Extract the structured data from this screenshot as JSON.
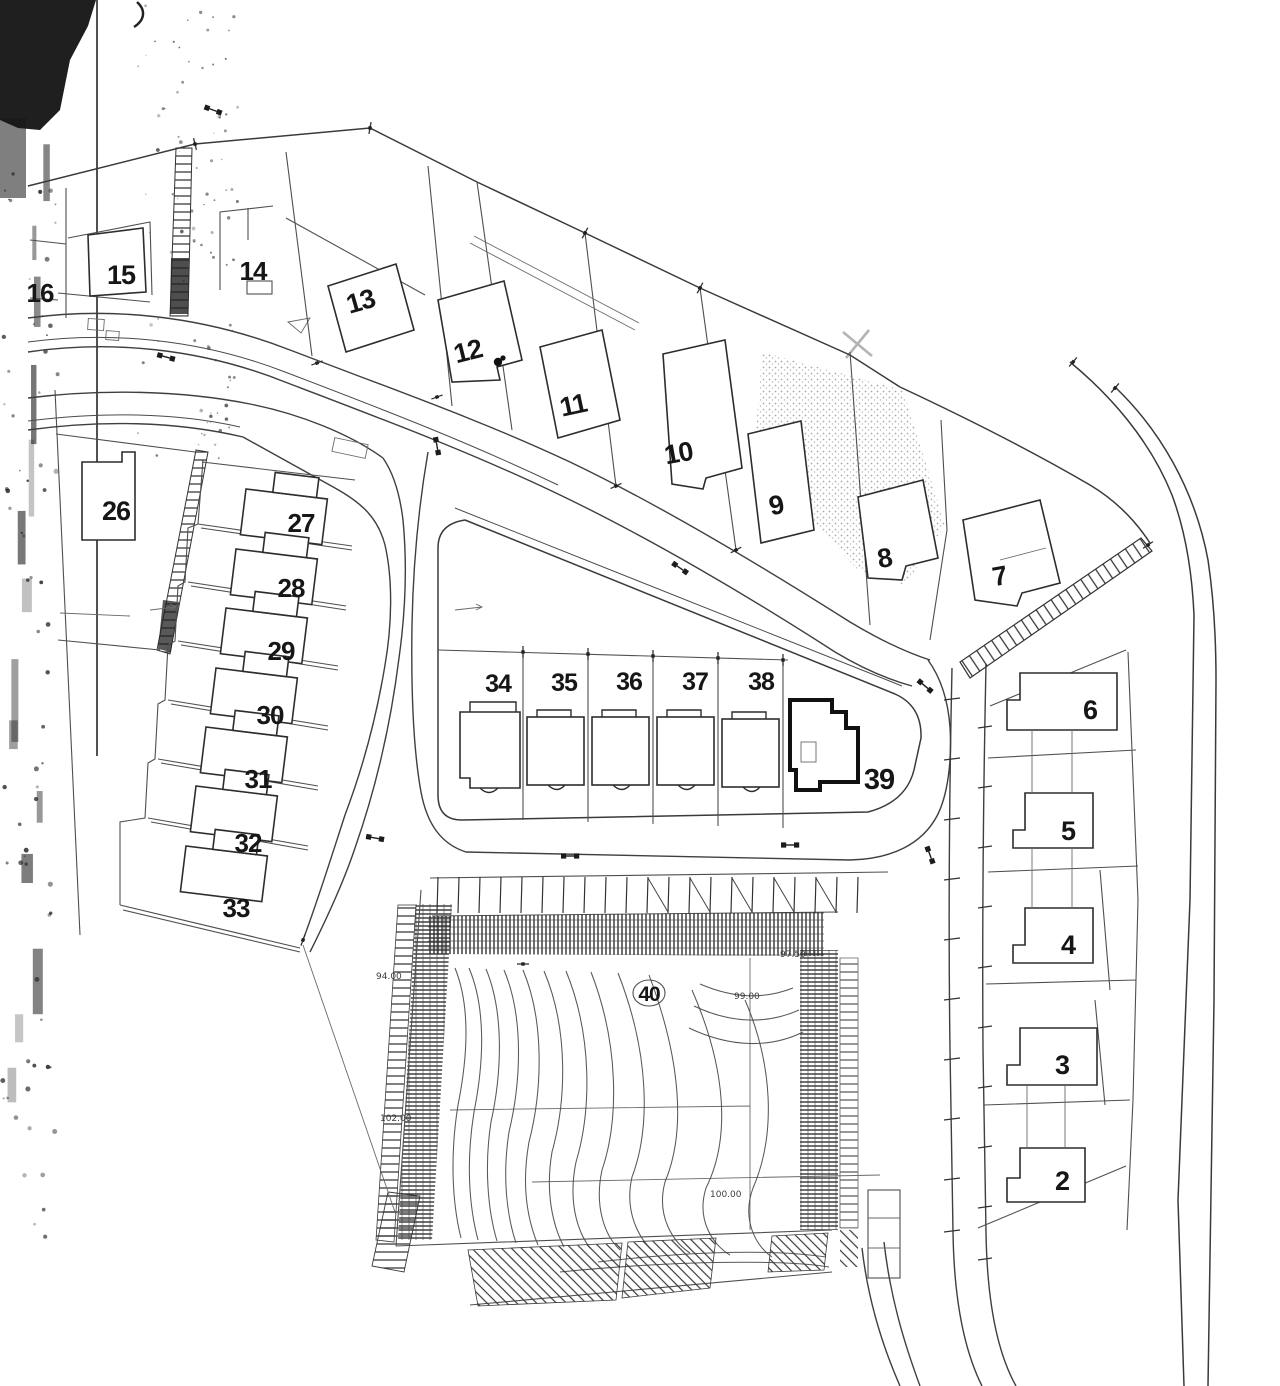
{
  "plan": {
    "kind": "scanned cadastral site plan",
    "colors": {
      "ink": "#2d2d2d",
      "paper": "#ffffff",
      "shade_stipple": "#9a9a9a"
    },
    "circled_lot": "40",
    "lots": [
      {
        "n": "2",
        "x": 1062,
        "y": 1190,
        "s": 27,
        "rot": 0
      },
      {
        "n": "3",
        "x": 1062,
        "y": 1074,
        "s": 27,
        "rot": 0
      },
      {
        "n": "4",
        "x": 1068,
        "y": 954,
        "s": 27,
        "rot": 0
      },
      {
        "n": "5",
        "x": 1068,
        "y": 840,
        "s": 27,
        "rot": 0
      },
      {
        "n": "6",
        "x": 1090,
        "y": 719,
        "s": 27,
        "rot": 0
      },
      {
        "n": "7",
        "x": 1001,
        "y": 585,
        "s": 27,
        "rot": -10
      },
      {
        "n": "8",
        "x": 886,
        "y": 567,
        "s": 27,
        "rot": -10
      },
      {
        "n": "9",
        "x": 778,
        "y": 514,
        "s": 27,
        "rot": -12
      },
      {
        "n": "10",
        "x": 680,
        "y": 462,
        "s": 27,
        "rot": -10
      },
      {
        "n": "11",
        "x": 575,
        "y": 414,
        "s": 27,
        "rot": -12
      },
      {
        "n": "12",
        "x": 470,
        "y": 360,
        "s": 27,
        "rot": -14
      },
      {
        "n": "13",
        "x": 363,
        "y": 310,
        "s": 27,
        "rot": -16
      },
      {
        "n": "14",
        "x": 253,
        "y": 280,
        "s": 26,
        "rot": 0
      },
      {
        "n": "15",
        "x": 121,
        "y": 284,
        "s": 27,
        "rot": 0
      },
      {
        "n": "16",
        "x": 40,
        "y": 302,
        "s": 26,
        "rot": 0
      },
      {
        "n": "26",
        "x": 116,
        "y": 520,
        "s": 27,
        "rot": 0
      },
      {
        "n": "27",
        "x": 301,
        "y": 532,
        "s": 26,
        "rot": 0
      },
      {
        "n": "28",
        "x": 291,
        "y": 597,
        "s": 26,
        "rot": 0
      },
      {
        "n": "29",
        "x": 281,
        "y": 660,
        "s": 26,
        "rot": 0
      },
      {
        "n": "30",
        "x": 270,
        "y": 724,
        "s": 26,
        "rot": 0
      },
      {
        "n": "31",
        "x": 258,
        "y": 788,
        "s": 26,
        "rot": 0
      },
      {
        "n": "32",
        "x": 248,
        "y": 852,
        "s": 26,
        "rot": 0
      },
      {
        "n": "33",
        "x": 236,
        "y": 917,
        "s": 26,
        "rot": 0
      },
      {
        "n": "34",
        "x": 498,
        "y": 692,
        "s": 25,
        "rot": 0
      },
      {
        "n": "35",
        "x": 564,
        "y": 691,
        "s": 25,
        "rot": 0
      },
      {
        "n": "36",
        "x": 629,
        "y": 690,
        "s": 25,
        "rot": 0
      },
      {
        "n": "37",
        "x": 695,
        "y": 690,
        "s": 25,
        "rot": 0
      },
      {
        "n": "38",
        "x": 761,
        "y": 690,
        "s": 25,
        "rot": 0
      },
      {
        "n": "39",
        "x": 879,
        "y": 789,
        "s": 29,
        "rot": 0
      },
      {
        "n": "40",
        "x": 649,
        "y": 1001,
        "s": 21,
        "rot": 0
      }
    ],
    "elevations": [
      {
        "t": "94.00",
        "x": 376,
        "y": 979
      },
      {
        "t": "102.00",
        "x": 380,
        "y": 1121
      },
      {
        "t": "99.00",
        "x": 734,
        "y": 999
      },
      {
        "t": "97.50",
        "x": 780,
        "y": 957
      },
      {
        "t": "100.00",
        "x": 710,
        "y": 1197
      }
    ]
  }
}
